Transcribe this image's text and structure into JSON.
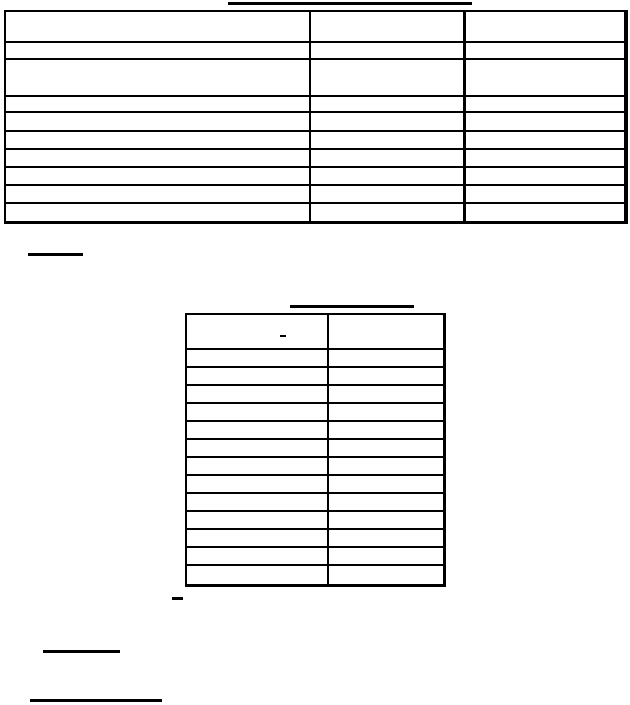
{
  "document": {
    "background_color": "#ffffff",
    "ink_color": "#000000",
    "top_title": {
      "text": "",
      "underlined": true
    },
    "note_heading": {
      "text": "",
      "underlined": true
    },
    "footer_heading_1": {
      "text": "",
      "underlined": true
    },
    "footer_heading_2": {
      "text": "",
      "underlined": true
    }
  },
  "table1": {
    "title": {
      "text": ""
    },
    "column_widths": [
      305,
      155,
      158
    ],
    "row_heights": [
      31,
      17,
      37,
      16,
      19,
      18,
      18,
      18,
      18,
      17
    ],
    "rows": [
      [
        "",
        "",
        ""
      ],
      [
        "",
        "",
        ""
      ],
      [
        "",
        "",
        ""
      ],
      [
        "",
        "",
        ""
      ],
      [
        "",
        "",
        ""
      ],
      [
        "",
        "",
        ""
      ],
      [
        "",
        "",
        ""
      ],
      [
        "",
        "",
        ""
      ],
      [
        "",
        "",
        ""
      ],
      [
        "",
        "",
        ""
      ]
    ]
  },
  "table2": {
    "title": {
      "text": "",
      "underlined": true
    },
    "column_widths": [
      142,
      114
    ],
    "header_row_height": 35,
    "body_row_height": 18,
    "rows": [
      [
        "-",
        ""
      ],
      [
        "",
        ""
      ],
      [
        "",
        ""
      ],
      [
        "",
        ""
      ],
      [
        "",
        ""
      ],
      [
        "",
        ""
      ],
      [
        "",
        ""
      ],
      [
        "",
        ""
      ],
      [
        "",
        ""
      ],
      [
        "",
        ""
      ],
      [
        "",
        ""
      ],
      [
        "",
        ""
      ],
      [
        "",
        ""
      ],
      [
        "",
        ""
      ]
    ]
  },
  "stray_marks": {
    "table2_header_dash": "-",
    "below_table2_dash": "-"
  }
}
